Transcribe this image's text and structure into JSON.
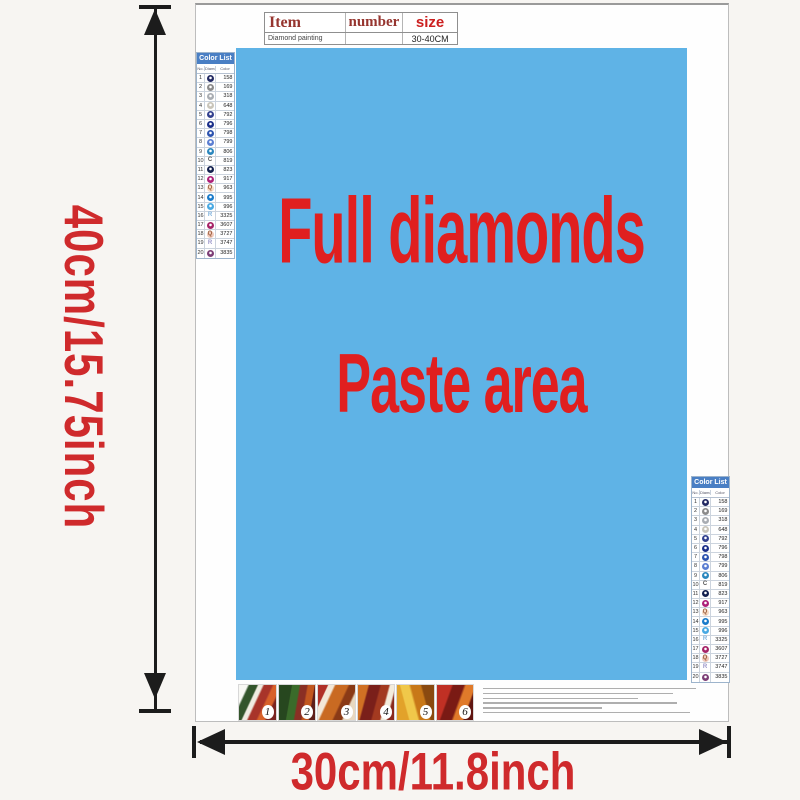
{
  "page": {
    "background": "#f7f5f2"
  },
  "dimension_labels": {
    "height": "40cm/15.75inch",
    "width": "30cm/11.8inch",
    "color": "#cf2a2c"
  },
  "item_table": {
    "headers": [
      {
        "label": "Item",
        "color": "#96352f"
      },
      {
        "label": "number",
        "color": "#96352f"
      },
      {
        "label": "size",
        "color": "#cc1f1f"
      }
    ],
    "row": {
      "item": "Diamond painting",
      "number": "",
      "size": "30-40CM"
    }
  },
  "paste_area": {
    "line1": "Full diamonds",
    "line2": "Paste area",
    "text_color": "#e01f1f",
    "background": "#5fb3e6"
  },
  "color_list": {
    "title": "Color List",
    "header_background": "#4a7fc4",
    "columns": [
      "No.",
      "Diamond",
      "Color"
    ],
    "rows": [
      {
        "no": "1",
        "code": "158",
        "style": "circle",
        "color": "#232a63"
      },
      {
        "no": "2",
        "code": "169",
        "style": "circle",
        "color": "#8b8b8b"
      },
      {
        "no": "3",
        "code": "318",
        "style": "circle",
        "color": "#a9adb3"
      },
      {
        "no": "4",
        "code": "648",
        "style": "circle",
        "color": "#c9c5ba"
      },
      {
        "no": "5",
        "code": "792",
        "style": "circle",
        "color": "#33418f"
      },
      {
        "no": "6",
        "code": "796",
        "style": "circle",
        "color": "#1b2f8a"
      },
      {
        "no": "7",
        "code": "798",
        "style": "circle",
        "color": "#2d54b0"
      },
      {
        "no": "8",
        "code": "799",
        "style": "circle",
        "color": "#5b7ed2"
      },
      {
        "no": "9",
        "code": "806",
        "style": "circle",
        "color": "#2b87be"
      },
      {
        "no": "10",
        "code": "819",
        "style": "letter",
        "symbol": "C",
        "color": "#555555"
      },
      {
        "no": "11",
        "code": "823",
        "style": "circle",
        "color": "#13204e"
      },
      {
        "no": "12",
        "code": "917",
        "style": "circle",
        "color": "#ae2079"
      },
      {
        "no": "13",
        "code": "963",
        "style": "letter",
        "symbol": "Q",
        "color": "#9a5c3a",
        "bg": "#f7dbc6"
      },
      {
        "no": "14",
        "code": "995",
        "style": "circle",
        "color": "#1a7bca"
      },
      {
        "no": "15",
        "code": "996",
        "style": "circle",
        "color": "#49a9e3"
      },
      {
        "no": "16",
        "code": "3325",
        "style": "letter",
        "symbol": "R",
        "color": "#7fb2de"
      },
      {
        "no": "17",
        "code": "3607",
        "style": "circle",
        "color": "#a62468"
      },
      {
        "no": "18",
        "code": "3727",
        "style": "letter",
        "symbol": "Q",
        "color": "#9a5c3a",
        "bg": "#f0c9bb"
      },
      {
        "no": "19",
        "code": "3747",
        "style": "letter",
        "symbol": "R",
        "color": "#9b96c9"
      },
      {
        "no": "20",
        "code": "3835",
        "style": "circle",
        "color": "#7d3f77"
      }
    ]
  },
  "steps": {
    "badges": [
      "1",
      "2",
      "3",
      "4",
      "5",
      "6"
    ]
  },
  "fine_print": {
    "lines": 6,
    "line_widths_percent": [
      100,
      89,
      73,
      91,
      56,
      97
    ]
  }
}
